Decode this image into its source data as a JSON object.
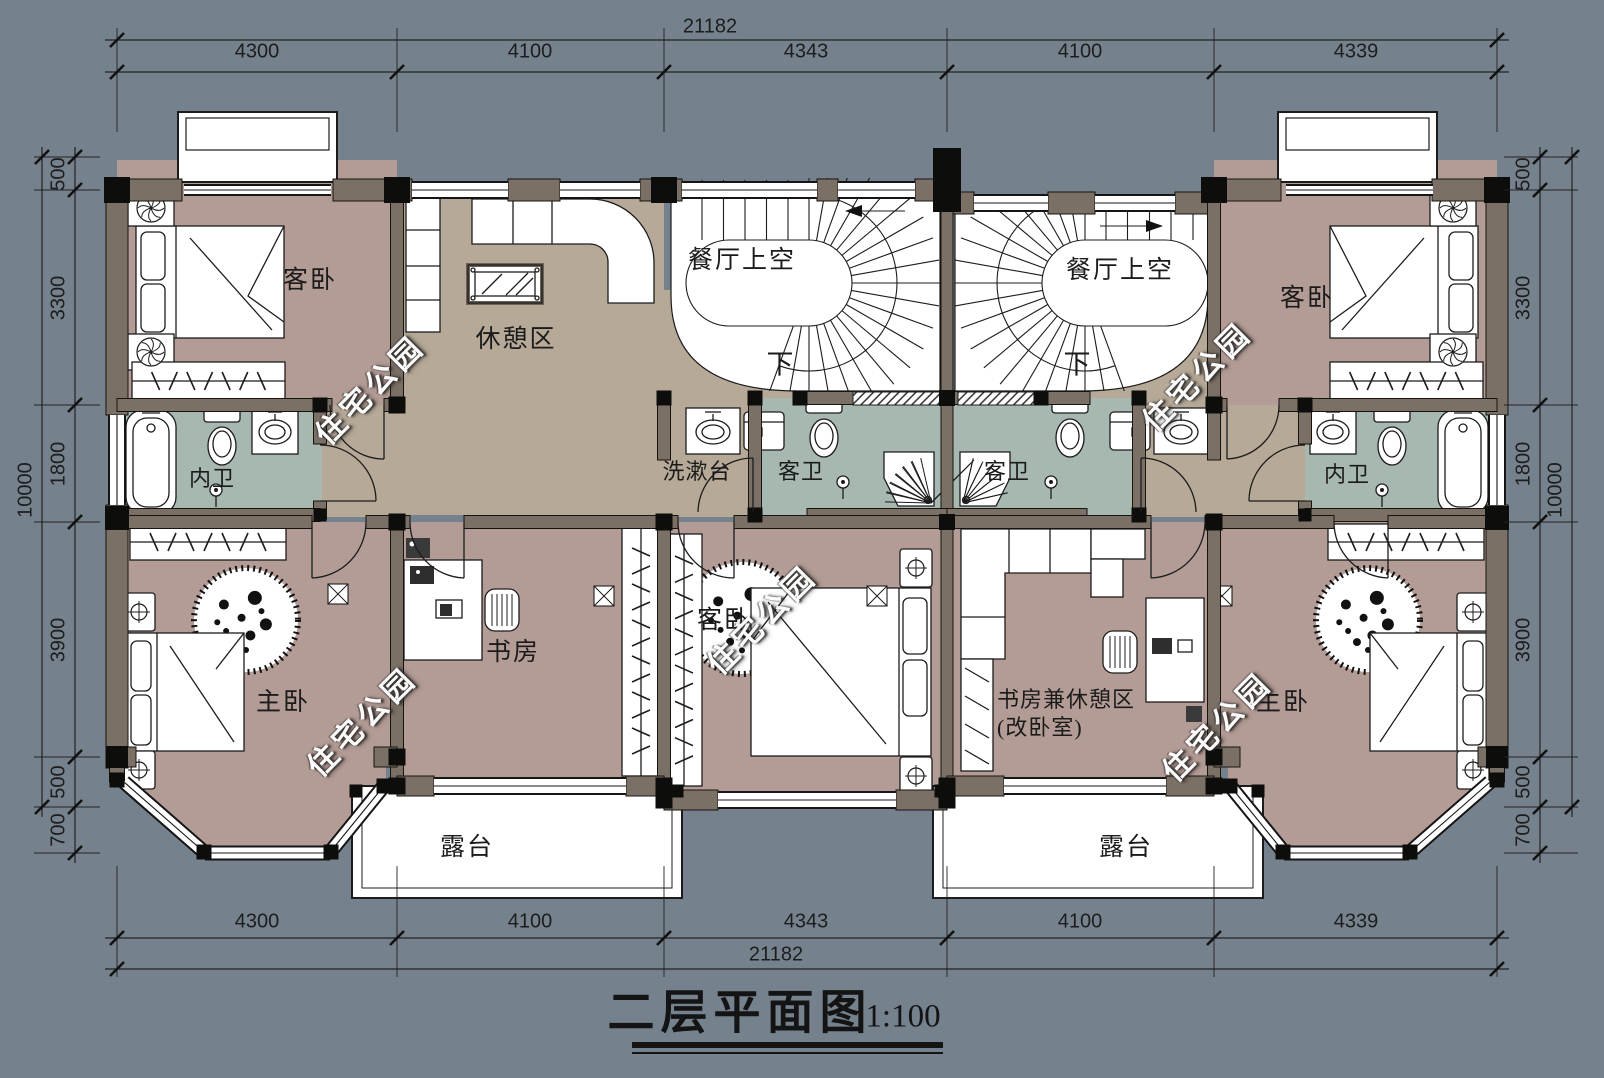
{
  "title": {
    "text": "二层平面图",
    "scale": "1:100"
  },
  "watermark_text": "住宅公园",
  "dims": {
    "top_total": "21182",
    "bottom_total": "21182",
    "top_segments": [
      "4300",
      "4100",
      "4343",
      "4100",
      "4339"
    ],
    "bottom_segments": [
      "4300",
      "4100",
      "4343",
      "4100",
      "4339"
    ],
    "left_total": "10000",
    "right_total": "10000",
    "left_segments": [
      "500",
      "3300",
      "1800",
      "3900",
      "500",
      "700"
    ],
    "right_segments": [
      "500",
      "3300",
      "1800",
      "3900",
      "500",
      "700"
    ]
  },
  "rooms": {
    "guest_bedroom_tl": "客卧",
    "lounge": "休憩区",
    "dining_void_left": "餐厅上空",
    "down_left": "下",
    "washstand": "洗漱台",
    "guest_bath_left": "客卫",
    "ensuite_left": "内卫",
    "master_left": "主卧",
    "study": "书房",
    "guest_bedroom_center": "客卧",
    "terrace_left": "露台",
    "dining_void_right": "餐厅上空",
    "down_right": "下",
    "guest_bath_right": "客卫",
    "ensuite_right": "内卫",
    "guest_bedroom_tr": "客卧",
    "study_lounge_line1": "书房兼休憩区",
    "study_lounge_line2": "(改卧室)",
    "master_right": "主卧",
    "terrace_right": "露台"
  },
  "colors": {
    "background": "#75828D",
    "bedroom_floor": "#B49C96",
    "hall_floor": "#B6A998",
    "bath_floor": "#A7B8B0",
    "wall_fill": "#7B7066",
    "column": "#0D0D0B",
    "line": "#1C1C1C",
    "paper": "#FFFFFF"
  }
}
